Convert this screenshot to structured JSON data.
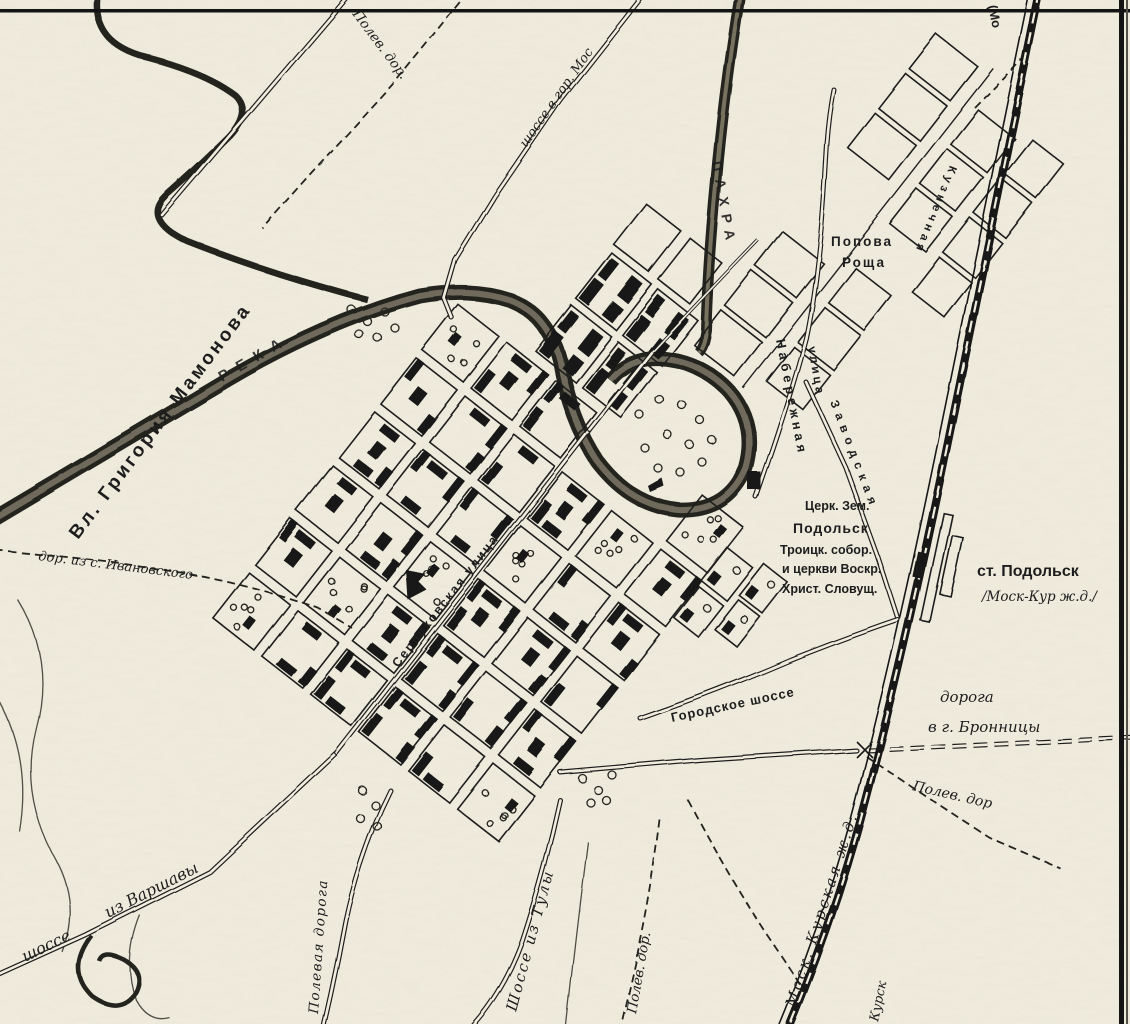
{
  "map": {
    "colors": {
      "paper": "#f2eee0",
      "ink": "#1d1d1d"
    },
    "labels": {
      "owner_estate": "Вл. Григория Мамонова",
      "river_word": "РЕКА",
      "river_pakhra": "ПАХРА",
      "popova_roshcha_line1": "Попова",
      "popova_roshcha_line2": "Роща",
      "church_land": "Церк. Зем.",
      "podolsk": "Подольск",
      "trinity_1": "Троицк. собор.",
      "trinity_2": "и церкви Воскр.",
      "trinity_3": "Христ. Словущ.",
      "station_line1": "ст. Подольск",
      "station_line2": "/Моск-Кур ж.д./",
      "naberezhnaya_1": "Набережная",
      "naberezhnaya_2": "улица",
      "serpukhovskaya": "Серпуховская улица",
      "zavodskaya": "Заводская",
      "kuznechnaya": "Кузнечная",
      "warsaw_1": "шоссе",
      "warsaw_2": "из Варшавы",
      "polevaya_doroga": "Полевая дорога",
      "tula": "Шоссе из Тулы",
      "polev_dor_s": "Полев. дор.",
      "polev_dor_n": "Полев. дор.",
      "polev_dor_e": "Полев. дор",
      "moscow_hwy": "шоссе в гор. Мос",
      "gorodskoe": "Городское шоссе",
      "bronnitsy_1": "дорога",
      "bronnitsy_2": "в г. Бронницы",
      "kurskaya_rr": "Моск. Курская ж.д.",
      "kursk": "Курск",
      "moscow_dir": "(Мо",
      "ivanovskoye": "дор. из с. Ивановского"
    }
  }
}
